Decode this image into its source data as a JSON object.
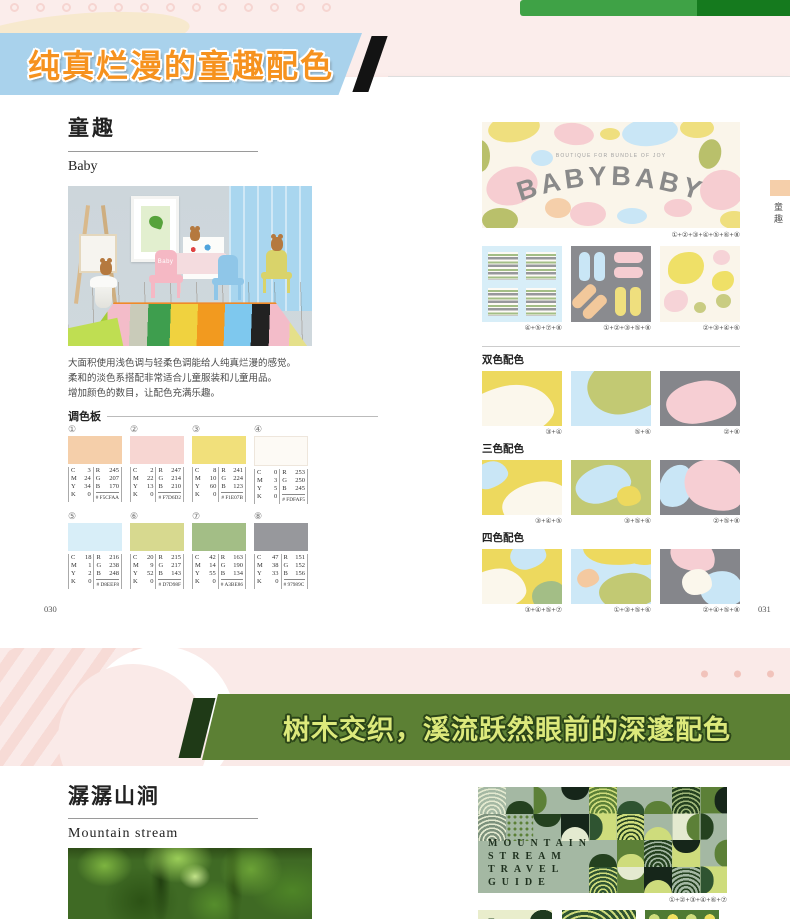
{
  "top_banner": {
    "title": "纯真烂漫的童趣配色"
  },
  "left_page": {
    "title": "童趣",
    "subtitle": "Baby",
    "photo_label": "Baby",
    "description": [
      "大面积使用浅色调与轻柔色调能给人纯真烂漫的感觉。",
      "柔和的淡色系搭配非常适合儿童服装和儿童用品。",
      "增加颜色的数目，让配色充满乐趣。"
    ],
    "palette_label": "调色板",
    "page_number": "030",
    "swatches": [
      {
        "num": "①",
        "c": "3",
        "m": "24",
        "y": "34",
        "k": "0",
        "r": "245",
        "g": "207",
        "b": "170",
        "hex": "# F5CFAA",
        "color": "#F5CFAA"
      },
      {
        "num": "②",
        "c": "2",
        "m": "22",
        "y": "13",
        "k": "0",
        "r": "247",
        "g": "214",
        "b": "210",
        "hex": "# F7D6D2",
        "color": "#F7D6D2"
      },
      {
        "num": "③",
        "c": "8",
        "m": "10",
        "y": "60",
        "k": "0",
        "r": "241",
        "g": "224",
        "b": "123",
        "hex": "# F1E07B",
        "color": "#F1E07B"
      },
      {
        "num": "④",
        "c": "0",
        "m": "3",
        "y": "5",
        "k": "0",
        "r": "253",
        "g": "250",
        "b": "245",
        "hex": "# FDFAF5",
        "color": "#FDFAF5"
      },
      {
        "num": "⑤",
        "c": "18",
        "m": "1",
        "y": "2",
        "k": "0",
        "r": "216",
        "g": "238",
        "b": "248",
        "hex": "# D8EEF8",
        "color": "#D8EEF8"
      },
      {
        "num": "⑥",
        "c": "20",
        "m": "9",
        "y": "52",
        "k": "0",
        "r": "215",
        "g": "217",
        "b": "143",
        "hex": "# D7D98F",
        "color": "#D7D98F"
      },
      {
        "num": "⑦",
        "c": "42",
        "m": "14",
        "y": "55",
        "k": "0",
        "r": "163",
        "g": "190",
        "b": "134",
        "hex": "# A3BE86",
        "color": "#A3BE86"
      },
      {
        "num": "⑧",
        "c": "47",
        "m": "38",
        "y": "33",
        "k": "0",
        "r": "151",
        "g": "152",
        "b": "156",
        "hex": "# 97989C",
        "color": "#97989C"
      }
    ]
  },
  "right_page": {
    "banner_subtitle": "BOUTIQUE FOR BUNDLE OF JOY",
    "banner_title": "BABYBABY",
    "banner_caption": "①+②+③+④+⑤+⑥+⑧",
    "design_captions": [
      "④+⑤+⑦+⑧",
      "①+②+③+⑤+⑧",
      "②+③+④+⑥"
    ],
    "sections": [
      {
        "label": "双色配色",
        "captions": [
          "③+④",
          "⑤+⑥",
          "②+⑧"
        ]
      },
      {
        "label": "三色配色",
        "captions": [
          "③+④+⑤",
          "③+⑤+⑥",
          "②+⑤+⑧"
        ]
      },
      {
        "label": "四色配色",
        "captions": [
          "③+④+⑤+⑦",
          "①+③+⑤+⑥",
          "②+④+⑤+⑧"
        ]
      }
    ],
    "page_number": "031",
    "side_tab": "童趣"
  },
  "bottom_banner": {
    "title": "树木交织，溪流跃然眼前的深邃配色"
  },
  "bottom_page": {
    "title": "潺潺山涧",
    "subtitle": "Mountain stream",
    "travel_lines": [
      "MOUNTAIN",
      "STREAM",
      "TRAVEL",
      "GUIDE"
    ],
    "travel_caption": "①+②+③+④+⑥+⑦"
  }
}
